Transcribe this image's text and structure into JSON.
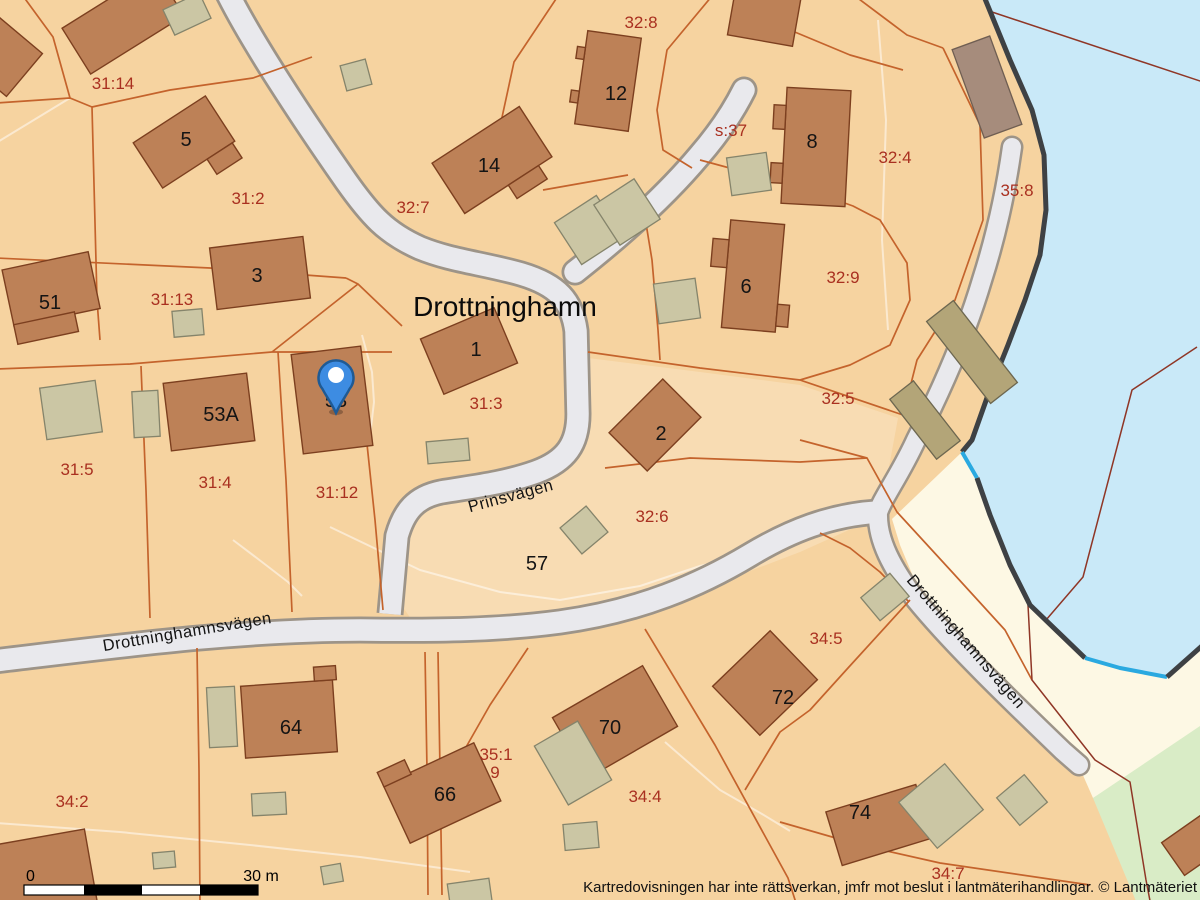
{
  "place": {
    "name": "Drottninghamn"
  },
  "labels": {
    "parcels": {
      "p31_14": "31:14",
      "p32_8": "32:8",
      "p31_2": "31:2",
      "p32_7": "32:7",
      "ps_37": "s:37",
      "p32_4": "32:4",
      "p35_8": "35:8",
      "p32_9": "32:9",
      "p31_13": "31:13",
      "p31_5": "31:5",
      "p31_4": "31:4",
      "p31_12": "31:12",
      "p31_3": "31:3",
      "p32_5": "32:5",
      "p32_6": "32:6",
      "p34_2": "34:2",
      "p34_5": "34:5",
      "p34_4": "34:4",
      "p34_7": "34:7",
      "p35_1": "35:1",
      "p9": "9"
    },
    "buildings": {
      "b5": "5",
      "b3": "3",
      "b51": "51",
      "b53A": "53A",
      "b53": "53",
      "b1": "1",
      "b2": "2",
      "b6": "6",
      "b8": "8",
      "b12": "12",
      "b14": "14",
      "b57": "57",
      "b64": "64",
      "b66": "66",
      "b70": "70",
      "b72": "72",
      "b74": "74"
    }
  },
  "roads": {
    "prinsvagen": "Prinsvägen",
    "drottninghamnsvagen_west": "Drottninghamnsvägen",
    "drottninghamnsvagen_southeast": "Drottninghamnsvägen"
  },
  "marker": {
    "icon": "location-pin",
    "color": "#3d8ce2"
  },
  "scalebar": {
    "start_label": "0",
    "end_label": "30 m"
  },
  "attribution": "Kartredovisningen har inte rättsverkan, jmfr mot beslut i lantmäterihandlingar. © Lantmäteriet",
  "colors": {
    "land": "#f6d3a0",
    "land_light": "#f8dcb3",
    "water": "#c9e9f8",
    "beach": "#fdf8e4",
    "green_area": "#d9ecc6",
    "building": "#bd8157",
    "outbuilding": "#cbc6a4",
    "coast_building": "#b3a578",
    "road_fill": "#e9e9ed",
    "road_casing": "#9d9488",
    "parcel_boundary": "#c4632c",
    "water_boundary": "#8f3626",
    "coastline": "#3e4144",
    "coast_highlight": "#2aa9e0",
    "parcel_label": "#a93020",
    "building_label": "#141414"
  }
}
